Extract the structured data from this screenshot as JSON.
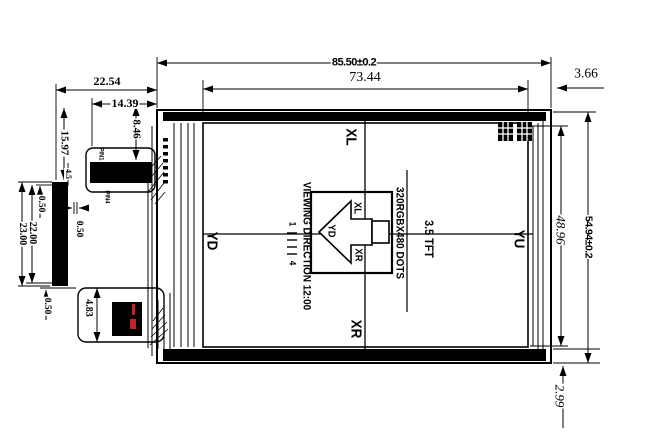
{
  "drawing": {
    "type": "TFT LCD module outline drawing",
    "colors": {
      "background": "#ffffff",
      "ink": "#000000",
      "accent_red": "#c32428"
    },
    "dimensions": {
      "width_total": "85.50±0.2",
      "width_active": "73.44",
      "edge_right": "3.66",
      "left_a": "22.54",
      "left_b": "14.39",
      "left_c": "8.46",
      "left_d": "15.97",
      "left_e": "4.5",
      "gap_top": "0.50",
      "height_a": "22.00",
      "height_b": "23.00",
      "gap_mid": "0.50",
      "gap_bottom": "0.50",
      "fpc_len": "4.83",
      "height_active": "48.96",
      "height_total": "54.94±0.2",
      "edge_bottom": "2.99"
    },
    "electrodes": {
      "top": "XL",
      "bottom": "XR",
      "left": "YD",
      "right": "YU",
      "box_xl": "XL",
      "box_yd": "YD",
      "box_xr": "XR"
    },
    "panel": {
      "size": "3.5 TFT",
      "resolution": "320RGBX480 DOTS",
      "viewing_direction": "VIEWING DIRECTION 12:00"
    },
    "pins": {
      "first": "1",
      "last": "4",
      "touch_pin1": "PIN1",
      "touch_pin4": "PIN4"
    }
  }
}
